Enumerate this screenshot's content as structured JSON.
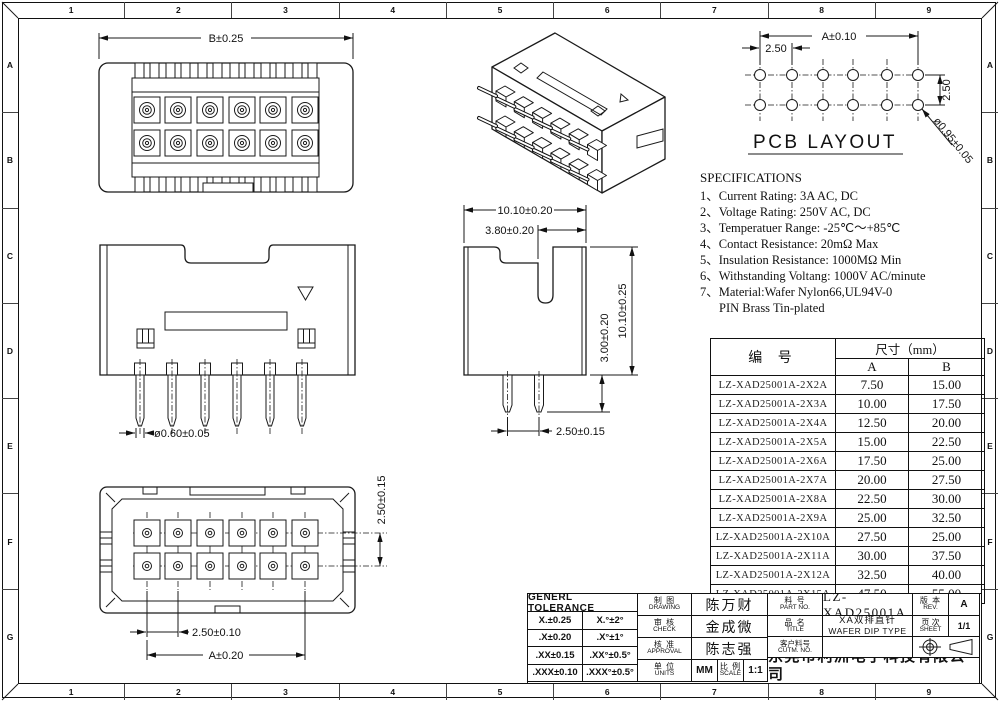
{
  "frame": {
    "top_zones": [
      "1",
      "2",
      "3",
      "4",
      "5",
      "6",
      "7",
      "8",
      "9"
    ],
    "bottom_zones": [
      "1",
      "2",
      "3",
      "4",
      "5",
      "6",
      "7",
      "8",
      "9"
    ],
    "left_zones": [
      "A",
      "B",
      "C",
      "D",
      "E",
      "F",
      "G"
    ],
    "right_zones": [
      "A",
      "B",
      "C",
      "D",
      "E",
      "F",
      "G"
    ]
  },
  "views": {
    "front": {
      "dim_width": "B±0.25"
    },
    "pcb": {
      "title": "PCB LAYOUT",
      "dim_span": "A±0.10",
      "dim_pitch": "2.50",
      "dim_row_pitch": "2.50",
      "dim_hole": "ø0.95±0.05"
    },
    "side": {
      "dim_pin_dia": "ø0.60±0.05"
    },
    "profile": {
      "dim_body_width": "10.10±0.20",
      "dim_slot": "3.80±0.20",
      "dim_body_height": "10.10±0.25",
      "dim_pin_length": "3.00±0.20",
      "dim_pin_pitch": "2.50±0.15"
    },
    "bottom": {
      "dim_row_pitch": "2.50±0.15",
      "dim_pin_pitch": "2.50±0.10",
      "dim_span": "A±0.20"
    }
  },
  "specifications": {
    "title": "SPECIFICATIONS",
    "items": [
      "1、Current Rating: 3A AC, DC",
      "2、Voltage Rating: 250V AC, DC",
      "3、Temperatuer Range: -25℃～+85℃",
      "4、Contact Resistance: 20mΩ Max",
      "5、Insulation Resistance: 1000MΩ Min",
      "6、Withstanding Voltang: 1000V AC/minute",
      "7、Material:Wafer Nylon66,UL94V-0",
      "PIN Brass Tin-plated"
    ]
  },
  "size_table": {
    "header_part": "编  号",
    "header_size": "尺寸（mm）",
    "header_a": "A",
    "header_b": "B",
    "rows": [
      {
        "part": "LZ-XAD25001A-2X2A",
        "a": "7.50",
        "b": "15.00"
      },
      {
        "part": "LZ-XAD25001A-2X3A",
        "a": "10.00",
        "b": "17.50"
      },
      {
        "part": "LZ-XAD25001A-2X4A",
        "a": "12.50",
        "b": "20.00"
      },
      {
        "part": "LZ-XAD25001A-2X5A",
        "a": "15.00",
        "b": "22.50"
      },
      {
        "part": "LZ-XAD25001A-2X6A",
        "a": "17.50",
        "b": "25.00"
      },
      {
        "part": "LZ-XAD25001A-2X7A",
        "a": "20.00",
        "b": "27.50"
      },
      {
        "part": "LZ-XAD25001A-2X8A",
        "a": "22.50",
        "b": "30.00"
      },
      {
        "part": "LZ-XAD25001A-2X9A",
        "a": "25.00",
        "b": "32.50"
      },
      {
        "part": "LZ-XAD25001A-2X10A",
        "a": "27.50",
        "b": "25.00"
      },
      {
        "part": "LZ-XAD25001A-2X11A",
        "a": "30.00",
        "b": "37.50"
      },
      {
        "part": "LZ-XAD25001A-2X12A",
        "a": "32.50",
        "b": "40.00"
      },
      {
        "part": "LZ-XAD25001A-2X15A",
        "a": "47.50",
        "b": "55.00"
      }
    ]
  },
  "title_block": {
    "tolerance": {
      "header": "GENERL TOLERANCE",
      "rows": [
        [
          "X.±0.25",
          "X.°±2°"
        ],
        [
          ".X±0.20",
          ".X°±1°"
        ],
        [
          ".XX±0.15",
          ".XX°±0.5°"
        ],
        [
          ".XXX±0.10",
          ".XXX°±0.5°"
        ]
      ]
    },
    "drawing": {
      "zh": "制 图",
      "en": "DRAWING",
      "value": "陈万财"
    },
    "check": {
      "zh": "审 核",
      "en": "CHECK",
      "value": "金成微"
    },
    "approval": {
      "zh": "核 准",
      "en": "APPROVAL",
      "value": "陈志强"
    },
    "units": {
      "zh": "单 位",
      "en": "UNITS",
      "value": "MM"
    },
    "scale": {
      "zh": "比 例",
      "en": "SCALE",
      "value": "1:1"
    },
    "part_no": {
      "zh": "料 号",
      "en": "PART NO.",
      "value": "LZ-XAD25001A"
    },
    "rev": {
      "zh": "版 本",
      "en": "REV.",
      "value": "A"
    },
    "product": {
      "zh": "品 名",
      "en": "TITLE",
      "value_zh": "XA双排直针",
      "value_en": "WAFER DIP TYPE"
    },
    "sheet": {
      "zh": "页 次",
      "en": "SHEET",
      "value": "1/1"
    },
    "customer": {
      "zh": "客户料号",
      "en": "CUTM. NO.",
      "value": ""
    },
    "company_zh": "东莞市利洲电子科技有限公司",
    "company_en": "DONGGUAN LIZHOU EL ECTRONIC TECHNOLOGY CO.,LTD"
  }
}
